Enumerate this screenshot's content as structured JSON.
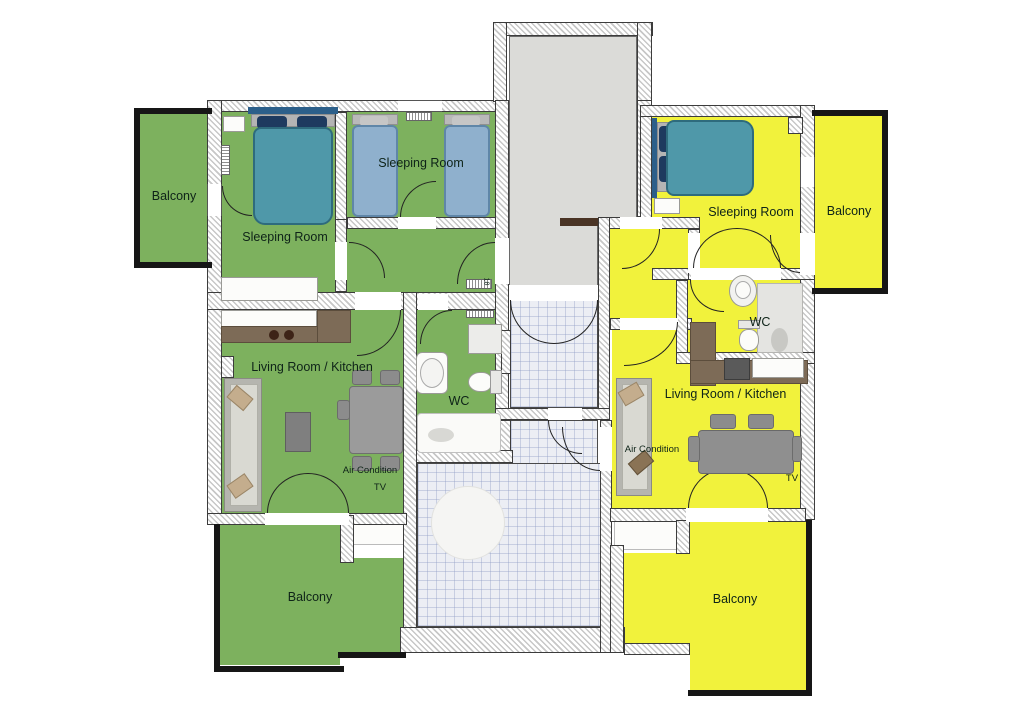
{
  "colors": {
    "green": "#7db15e",
    "yellow": "#f1f23c",
    "stairwell": "#dbdbd8",
    "tile": "#eceef4",
    "hatch": "#c7c7c7",
    "bed_double": "#4f98a9",
    "bed_single": "#8fb0cd",
    "pillow": "#1e3a5f",
    "counter": "#7d6b57",
    "railing": "#161616",
    "label": "#0e2318"
  },
  "left_apartment": {
    "balcony_top": "Balcony",
    "sleeping_room_1": "Sleeping Room",
    "sleeping_room_2": "Sleeping Room",
    "living_room": "Living Room / Kitchen",
    "wc": "WC",
    "air_condition": "Air Condition",
    "tv": "TV",
    "balcony_bottom": "Balcony",
    "radiator_label": "18"
  },
  "right_apartment": {
    "sleeping_room": "Sleeping Room",
    "balcony_right": "Balcony",
    "wc": "WC",
    "living_room": "Living Room / Kitchen",
    "air_condition": "Air Condition",
    "tv": "TV",
    "balcony_bottom": "Balcony"
  }
}
